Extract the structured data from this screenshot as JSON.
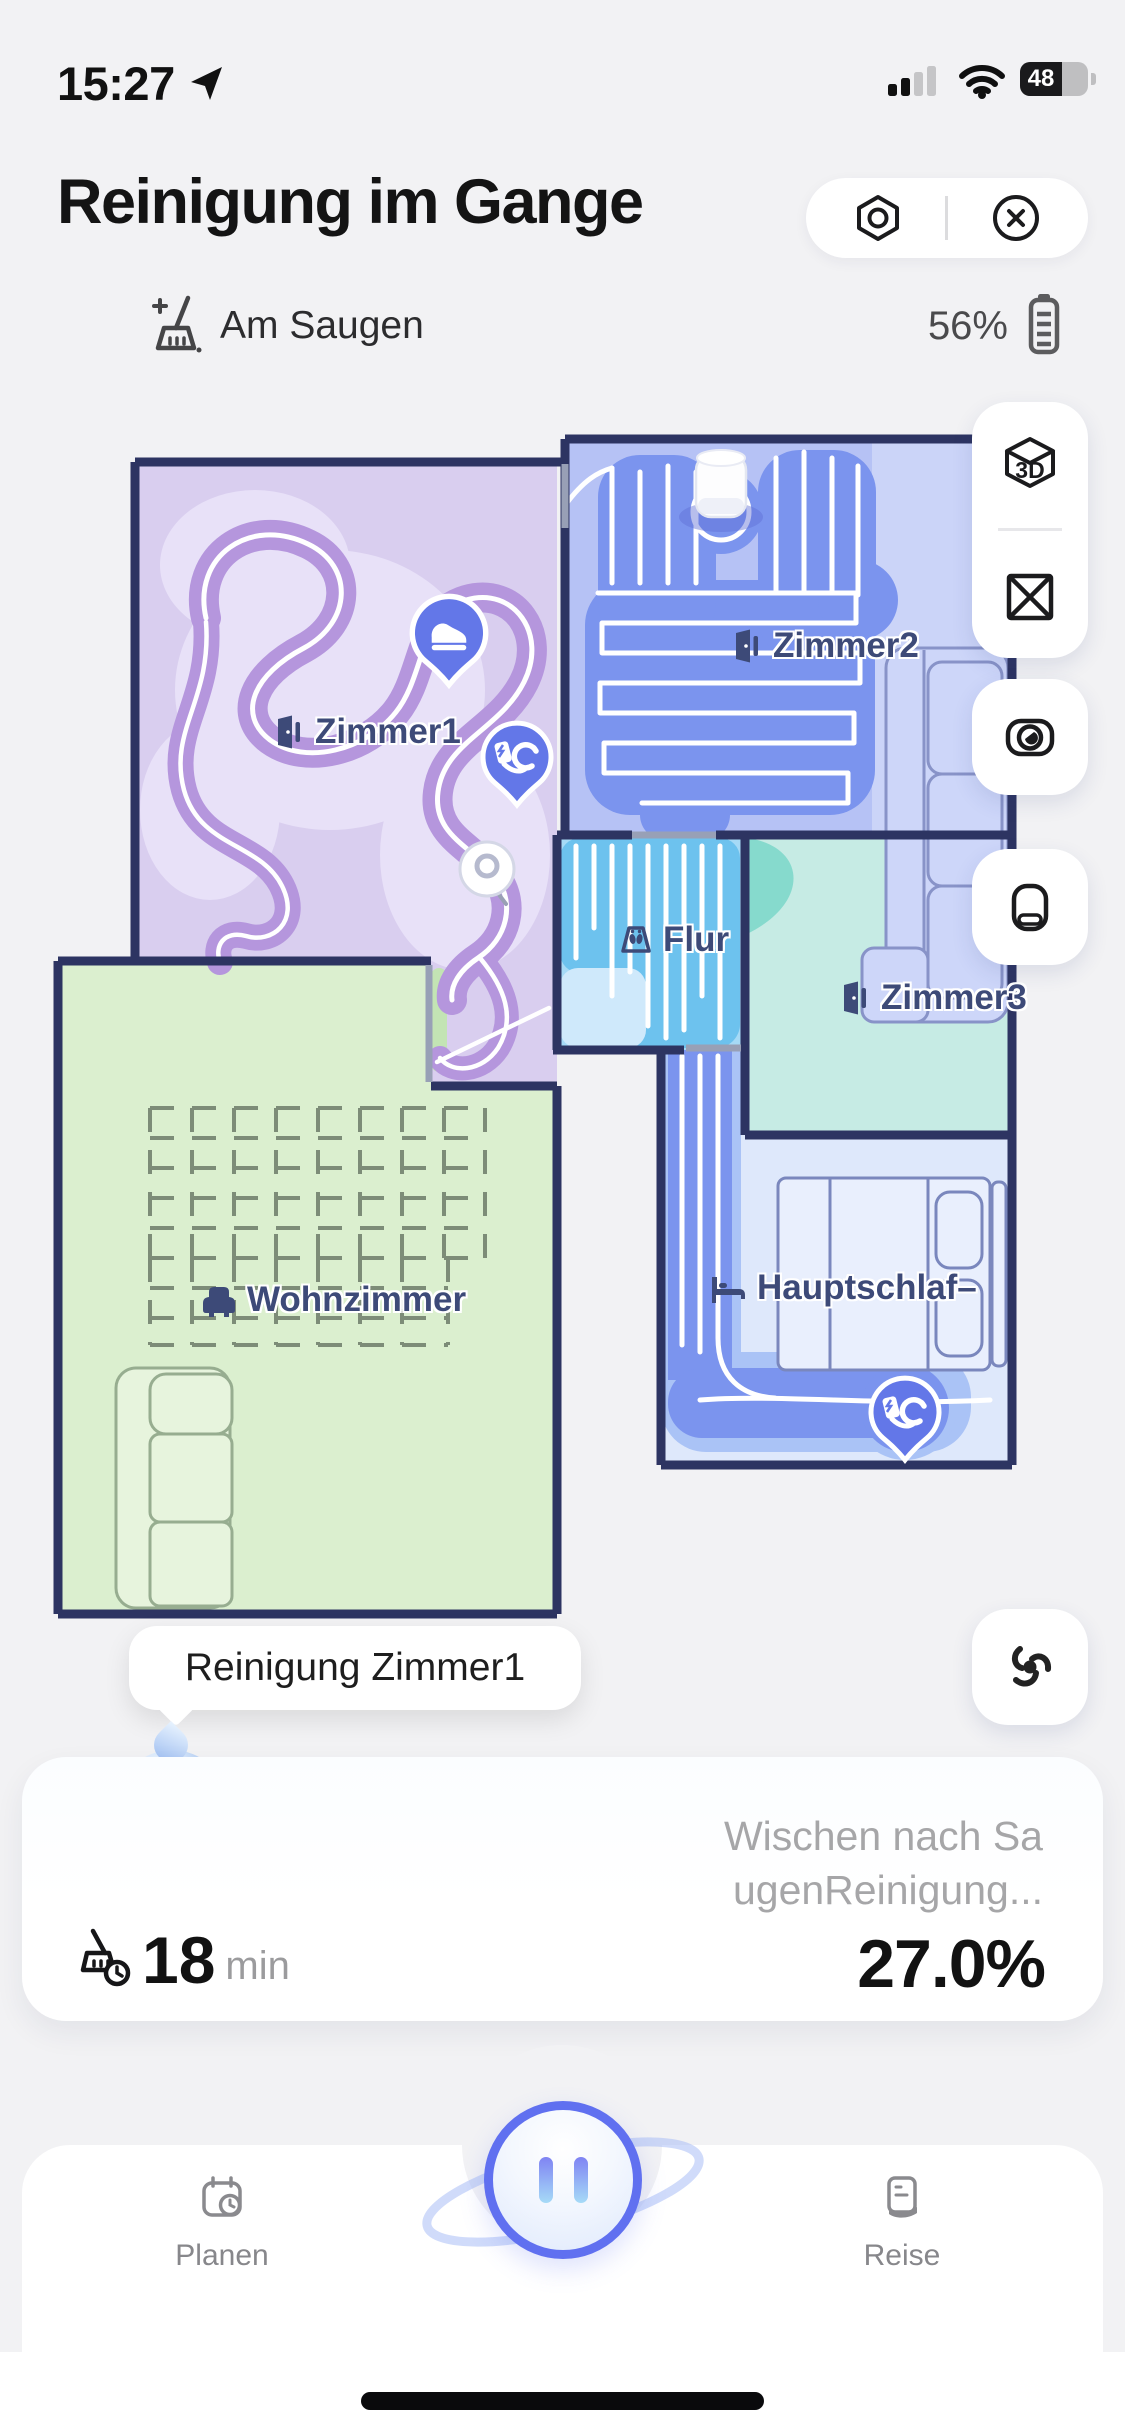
{
  "status_bar": {
    "time": "15:27",
    "battery_percent": "48"
  },
  "header": {
    "title": "Reinigung im Gange"
  },
  "status_row": {
    "activity_label": "Am Saugen",
    "battery_label": "56%"
  },
  "map": {
    "rooms": [
      {
        "id": "zimmer1",
        "label": "Zimmer1"
      },
      {
        "id": "zimmer2",
        "label": "Zimmer2"
      },
      {
        "id": "flur",
        "label": "Flur"
      },
      {
        "id": "zimmer3",
        "label": "Zimmer3"
      },
      {
        "id": "wohnzimmer",
        "label": "Wohnzimmer"
      },
      {
        "id": "hauptschlafzimmer",
        "label": "Hauptschlaf–"
      }
    ],
    "controls": {
      "cube_label": "3D"
    }
  },
  "tooltip": {
    "text": "Reinigung Zimmer1"
  },
  "task_card": {
    "mode_line1": "Wischen nach Sa",
    "mode_line2": "ugenReinigung...",
    "minutes": "18",
    "minutes_unit": "min",
    "progress": "27.0%"
  },
  "nav": {
    "plan_label": "Planen",
    "journey_label": "Reise"
  },
  "colors": {
    "accent_pin": "#6377e8",
    "wall": "#2d3462",
    "clean_blue": "#7b94ee",
    "clean_purple": "#b596dd",
    "clean_cyan": "#6dc2ee",
    "room_purple": "#d9ceef",
    "room_blue": "#b6c2f5",
    "room_sky": "#a6daf6",
    "room_teal": "#c6ebe4",
    "room_green": "#dbefcf",
    "room_lightblue": "#dee8fb"
  }
}
